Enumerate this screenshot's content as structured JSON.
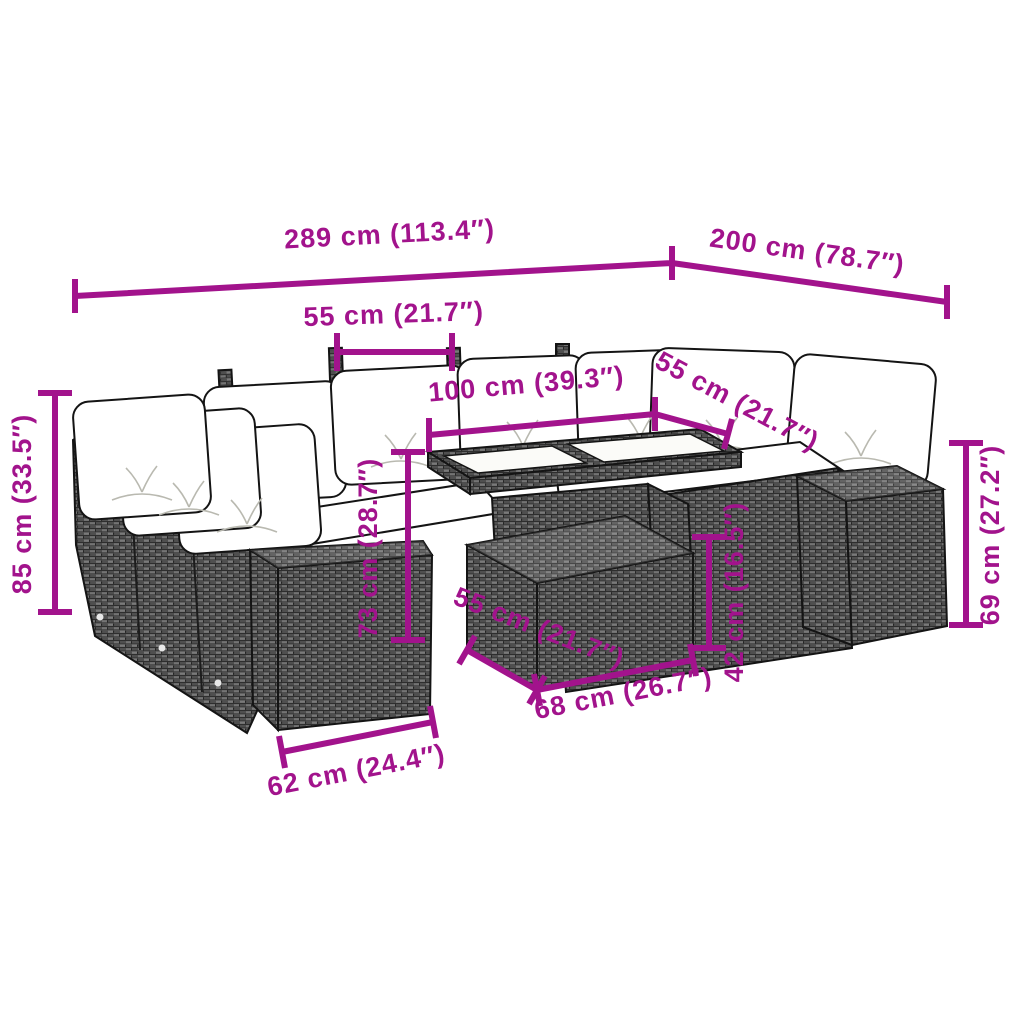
{
  "diagram": {
    "description": "Rattan garden lounge set with cushions, dining table and ottoman, annotated with product dimensions",
    "colors": {
      "dimension_line": "#A2138C",
      "background": "#FFFFFF",
      "outline": "#141414",
      "rattan_dark": "#4F4F4F",
      "rattan_light": "#7A7A7A",
      "cushion": "#FFFFFF",
      "glass": "#FBFBF8"
    },
    "dimensions": {
      "d289": "289 cm (113.4″)",
      "d200": "200 cm (78.7″)",
      "d55_top": "55 cm (21.7″)",
      "d100": "100 cm (39.3″)",
      "d55_right": "55 cm (21.7″)",
      "d85": "85 cm (33.5″)",
      "d73": "73 cm (28.7″)",
      "d42": "42 cm (16.5″)",
      "d69": "69 cm (27.2″)",
      "d55_bottom": "55 cm (21.7″)",
      "d68": "68 cm (26.7″)",
      "d62": "62 cm (24.4″)"
    }
  }
}
